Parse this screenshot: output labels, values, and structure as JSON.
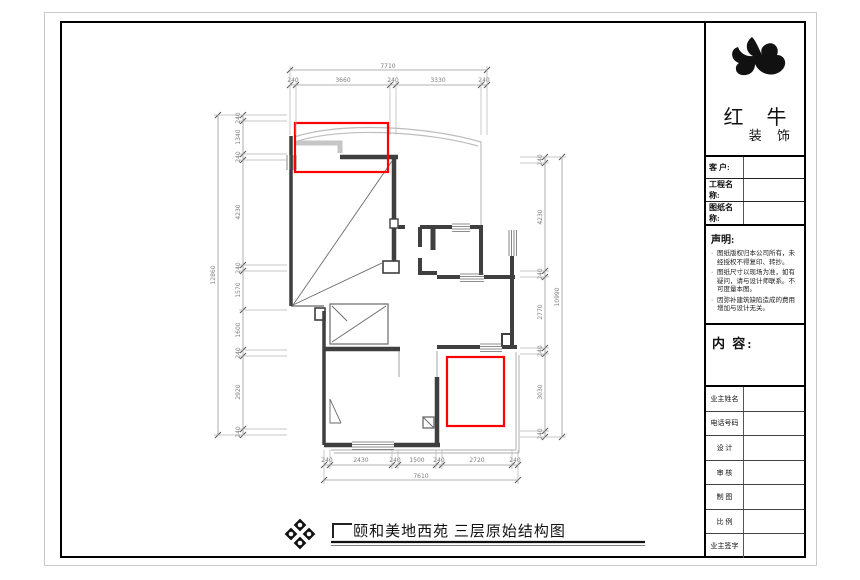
{
  "colors": {
    "highlight_red": "#ff0000",
    "wall_dark": "#3f3f3f",
    "dimension_gray": "#7d7d7d",
    "terrace_outline_gray": "#bdbdbd",
    "frame_black": "#000000"
  },
  "drawing": {
    "dimensions": {
      "top": {
        "overall": "7710",
        "chain": [
          "240",
          "3660",
          "240",
          "3330",
          "240"
        ]
      },
      "bottom": {
        "overall": "7610",
        "chain": [
          "240",
          "2430",
          "240",
          "1500",
          "240",
          "2720",
          "240"
        ]
      },
      "left": {
        "overall": "12860",
        "chain": [
          "240",
          "1340",
          "240",
          "4230",
          "240",
          "1570",
          "1600",
          "240",
          "2920",
          "240"
        ]
      },
      "right": {
        "overall": "10990",
        "chain": [
          "240",
          "4230",
          "240",
          "2770",
          "240",
          "3030",
          "240"
        ]
      }
    }
  },
  "footer": {
    "title": "颐和美地西苑 三层原始结构图"
  },
  "title_block": {
    "brand": {
      "name_top": "红 牛",
      "name_bottom": "装 饰"
    },
    "fields": [
      {
        "label": "客 户:"
      },
      {
        "label": "工程名称:"
      },
      {
        "label": "图纸名称:"
      }
    ],
    "statement": {
      "title": "声明:",
      "marker": "·",
      "items": [
        "图纸版权归本公司所有，未经授权不得复印、转抄。",
        "图纸尺寸以现场为准，如有疑问，请与设计师联系。不可度量本图。",
        "因弥补建筑缺陷造成的费用增加与设计无关。"
      ]
    },
    "content_label": "内 容:",
    "info_rows": [
      {
        "label": "业主姓名"
      },
      {
        "label": "电话号码"
      },
      {
        "label": "设 计"
      },
      {
        "label": "审 核"
      },
      {
        "label": "制 图"
      },
      {
        "label": "比 例"
      },
      {
        "label": "业主签字"
      }
    ]
  }
}
